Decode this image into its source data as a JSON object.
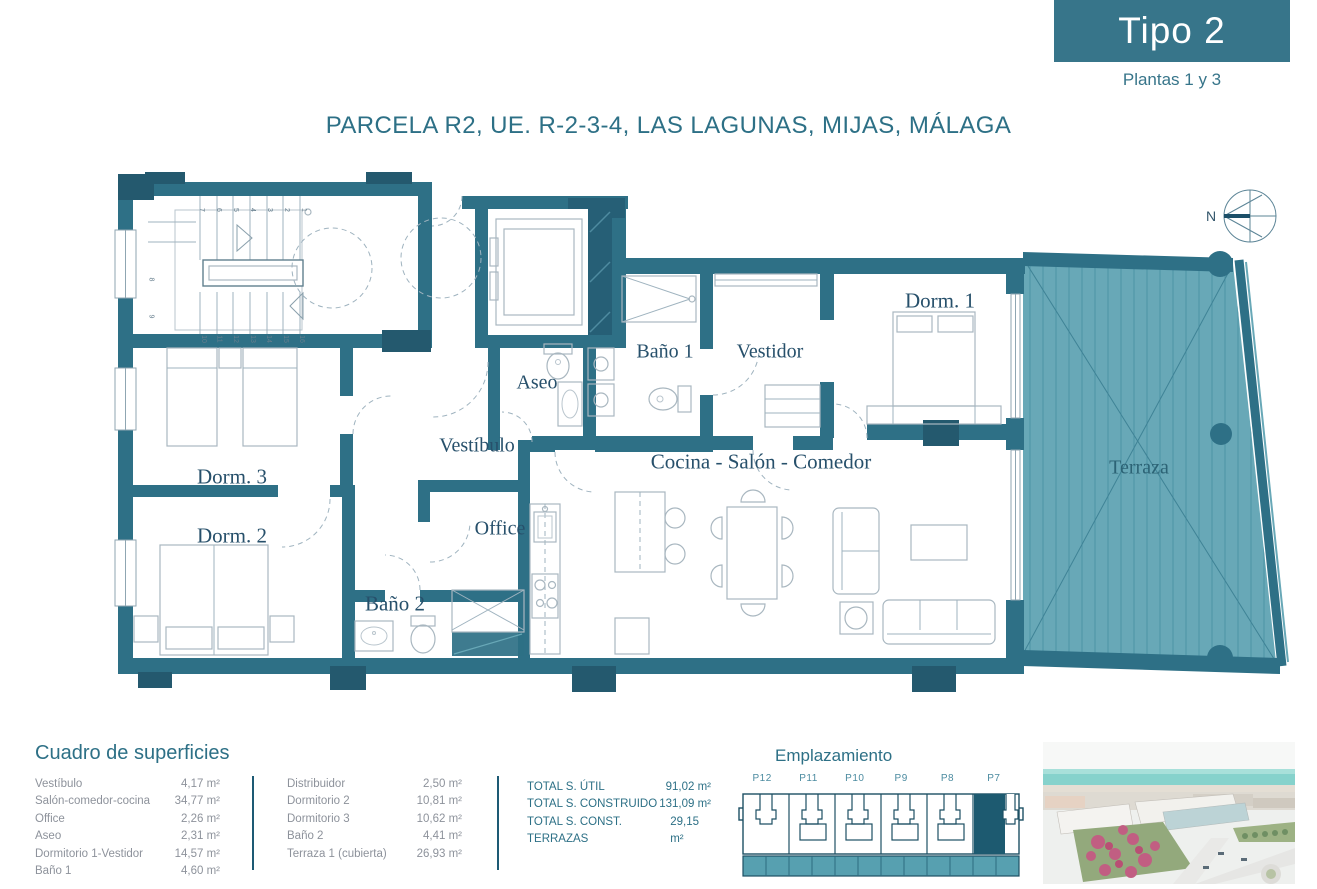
{
  "header": {
    "type_badge": "Tipo 2",
    "floors": "Plantas 1 y 3",
    "title": "PARCELA R2, UE. R-2-3-4, LAS LAGUNAS, MIJAS, MÁLAGA"
  },
  "compass": {
    "north_label": "N"
  },
  "plan": {
    "rooms": {
      "dorm1": "Dorm. 1",
      "bano1": "Baño 1",
      "vestidor": "Vestidor",
      "aseo": "Aseo",
      "vestibulo": "Vestíbulo",
      "dorm3": "Dorm. 3",
      "dorm2": "Dorm. 2",
      "office": "Office",
      "bano2": "Baño 2",
      "salon": "Cocina - Salón - Comedor",
      "terraza": "Terraza"
    },
    "stairs": {
      "top": [
        "7",
        "6",
        "5",
        "4",
        "3",
        "2",
        "1"
      ],
      "left": [
        "8",
        "9"
      ],
      "bottom": [
        "10",
        "11",
        "12",
        "13",
        "14",
        "15",
        "16"
      ]
    }
  },
  "surfaces": {
    "title": "Cuadro de superficies",
    "col1": [
      {
        "label": "Vestíbulo",
        "value": "4,17 m²"
      },
      {
        "label": "Salón-comedor-cocina",
        "value": "34,77 m²"
      },
      {
        "label": "Office",
        "value": "2,26 m²"
      },
      {
        "label": "Aseo",
        "value": "2,31 m²"
      },
      {
        "label": "Dormitorio 1-Vestidor",
        "value": "14,57 m²"
      },
      {
        "label": "Baño 1",
        "value": "4,60 m²"
      }
    ],
    "col2": [
      {
        "label": "Distribuidor",
        "value": "2,50 m²"
      },
      {
        "label": "Dormitorio 2",
        "value": "10,81 m²"
      },
      {
        "label": "Dormitorio 3",
        "value": "10,62 m²"
      },
      {
        "label": "Baño 2",
        "value": "4,41 m²"
      },
      {
        "label": "Terraza 1 (cubierta)",
        "value": "26,93 m²"
      }
    ],
    "totals": [
      {
        "label": "TOTAL S. ÚTIL",
        "value": "91,02 m²"
      },
      {
        "label": "TOTAL S. CONSTRUIDO",
        "value": "131,09 m²"
      },
      {
        "label": "TOTAL S. CONST. TERRAZAS",
        "value": "29,15 m²"
      }
    ]
  },
  "emplazamiento": {
    "title": "Emplazamiento",
    "units": [
      "P12",
      "P11",
      "P10",
      "P9",
      "P8",
      "P7"
    ],
    "highlighted_unit": "P7"
  },
  "colors": {
    "accent": "#2d7086",
    "wall": "#2e7086",
    "wall_dark": "#24596e",
    "terrace_fill": "#68a8b7",
    "highlight_unit": "#1d5a70",
    "table_text": "#8d929b"
  }
}
